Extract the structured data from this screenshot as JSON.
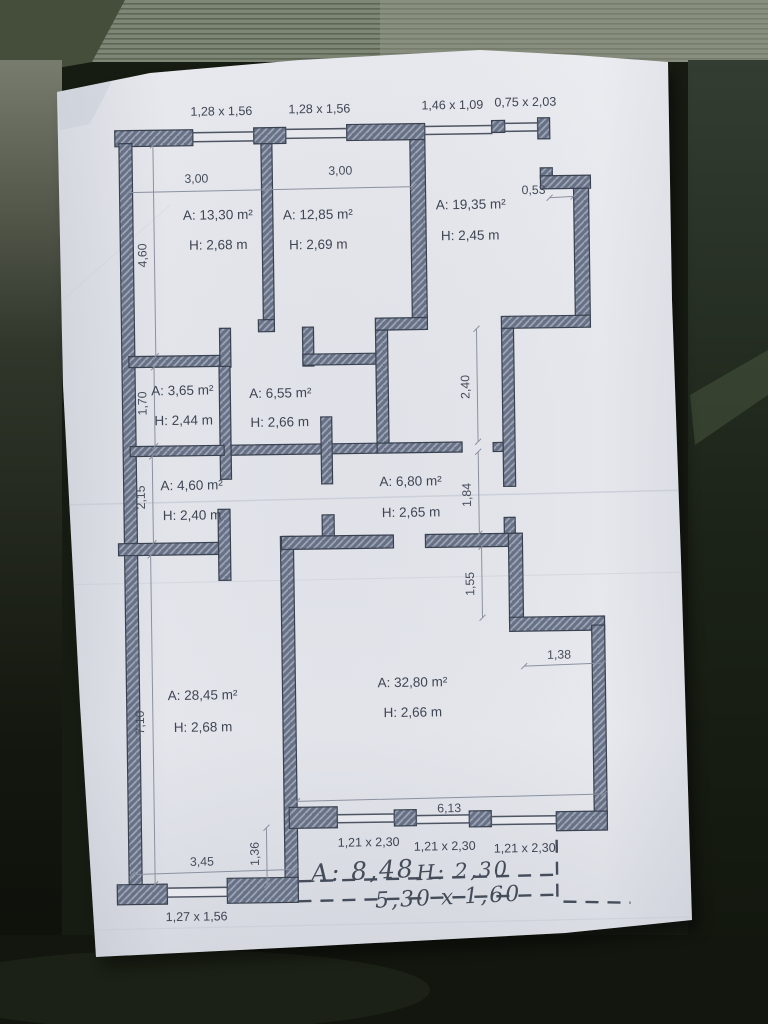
{
  "plan": {
    "window_labels_top": [
      "1,28 x 1,56",
      "1,28 x 1,56",
      "1,46 x 1,09",
      "0,75 x 2,03"
    ],
    "rooms": [
      {
        "name": "room-13-30",
        "area": "A: 13,30 m²",
        "height": "H: 2,68 m"
      },
      {
        "name": "room-12-85",
        "area": "A: 12,85 m²",
        "height": "H: 2,69 m"
      },
      {
        "name": "room-19-35",
        "area": "A: 19,35 m²",
        "height": "H: 2,45 m"
      },
      {
        "name": "room-3-65",
        "area": "A: 3,65 m²",
        "height": "H: 2,44 m"
      },
      {
        "name": "room-6-55",
        "area": "A: 6,55 m²",
        "height": "H: 2,66 m"
      },
      {
        "name": "room-4-60",
        "area": "A: 4,60 m²",
        "height": "H: 2,40 m"
      },
      {
        "name": "room-6-80",
        "area": "A: 6,80 m²",
        "height": "H: 2,65 m"
      },
      {
        "name": "room-28-45",
        "area": "A: 28,45 m²",
        "height": "H: 2,68 m"
      },
      {
        "name": "room-32-80",
        "area": "A: 32,80 m²",
        "height": "H: 2,66 m"
      }
    ],
    "dims": {
      "w_room1": "3,00",
      "w_room2": "3,00",
      "niche": "0,53",
      "v_room1": "4,60",
      "v_365": "1,70",
      "v_460": "2,15",
      "v_2845": "7,10",
      "v_corridor": "2,40",
      "v_hall": "1,84",
      "v_notch": "1,55",
      "h_notch": "1,38",
      "h_3280": "6,13",
      "v_offset": "1,36",
      "h_2845": "3,45"
    },
    "window_labels_bottom": [
      "1,21 x 2,30",
      "1,21 x 2,30",
      "1,21 x 2,30"
    ],
    "window_label_bottom_left": "1,27 x 1,56",
    "handwritten": {
      "area": "A: 8,48",
      "height": "H: 2,30",
      "size": "5,30 x 1,60"
    }
  },
  "colors": {
    "paper": "#e4e6ec",
    "wall_fill": "#667087",
    "wall_hatch": "#9fa6b4",
    "wall_stroke": "#3a4250",
    "ink": "#3e4553",
    "dim_line": "#8a91a0",
    "background": "#171c13"
  }
}
